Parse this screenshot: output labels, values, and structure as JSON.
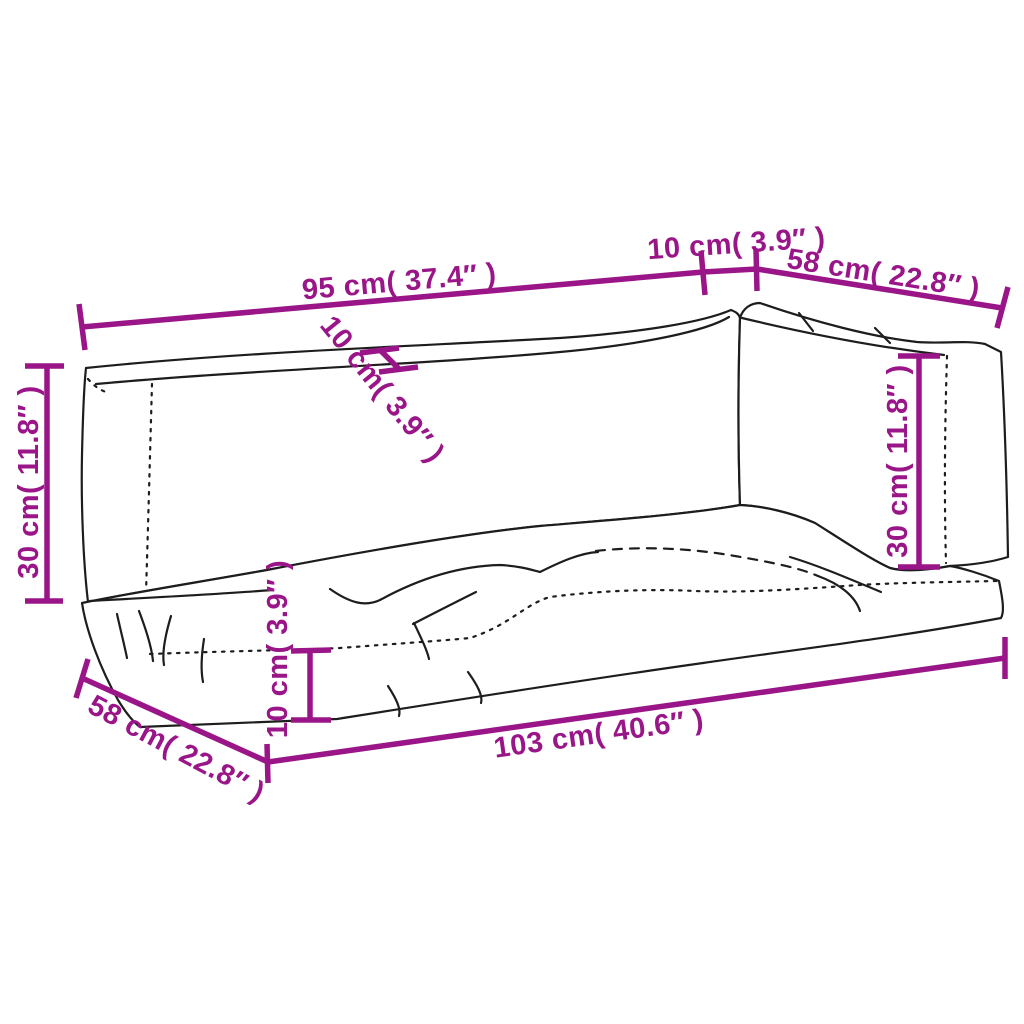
{
  "diagram": {
    "kind": "product dimensions line drawing",
    "subject": "three-piece pallet sofa cushion set (back cushion, side back cushion, seat cushion)",
    "colors": {
      "dimension_accent": "#9A1688",
      "outline": "#1d1d1d",
      "background": "#ffffff"
    },
    "labels": {
      "back_width": "95 cm( 37.4″ )",
      "top_gap": "10 cm( 3.9″ )",
      "side_width": "58 cm( 22.8″ )",
      "back_height": "30 cm( 11.8″ )",
      "back_thickness": "10 cm( 3.9″ )",
      "side_height": "30 cm( 11.8″ )",
      "seat_thickness": "10 cm( 3.9″ )",
      "seat_depth": "58 cm( 22.8″ )",
      "seat_length": "103 cm( 40.6″ )"
    }
  }
}
